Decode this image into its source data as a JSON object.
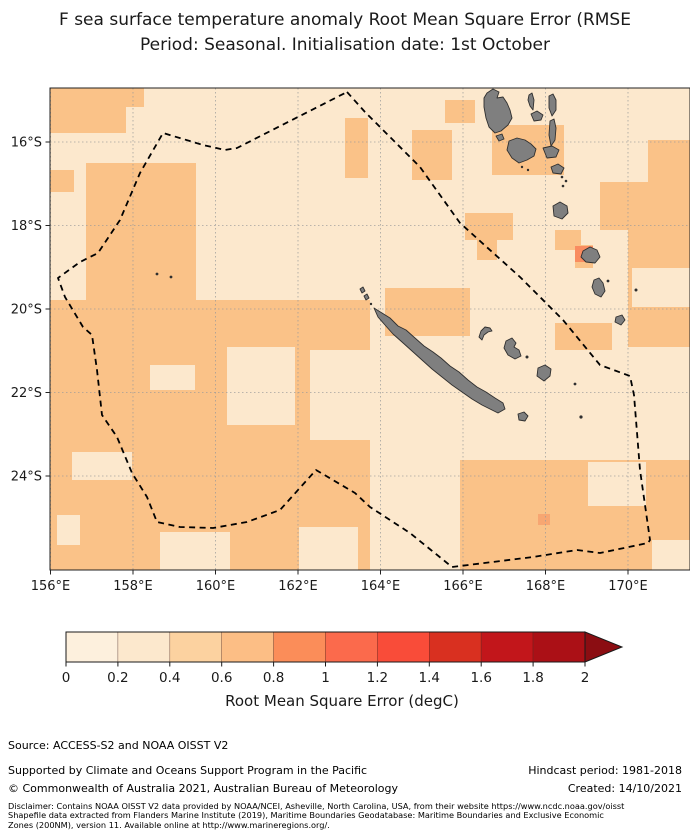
{
  "title": {
    "line1": "F sea surface temperature anomaly Root Mean Square Error (RMSE",
    "line2": "Period: Seasonal. Initialisation date: 1st October"
  },
  "map": {
    "frame": {
      "x": 50,
      "y": 88,
      "w": 640,
      "h": 482
    },
    "x_ticks": [
      {
        "label": "156°E",
        "x": 50.5
      },
      {
        "label": "158°E",
        "x": 133
      },
      {
        "label": "160°E",
        "x": 215.5
      },
      {
        "label": "162°E",
        "x": 298
      },
      {
        "label": "164°E",
        "x": 380.5
      },
      {
        "label": "166°E",
        "x": 463
      },
      {
        "label": "168°E",
        "x": 545.5
      },
      {
        "label": "170°E",
        "x": 628
      }
    ],
    "y_ticks": [
      {
        "label": "16°S",
        "y": 142
      },
      {
        "label": "18°S",
        "y": 225.5
      },
      {
        "label": "20°S",
        "y": 309
      },
      {
        "label": "22°S",
        "y": 392.5
      },
      {
        "label": "24°S",
        "y": 476
      }
    ],
    "colors": {
      "sea_light": "#fce8cd",
      "sea_medium": "#fac288",
      "land": "#7f7f7f",
      "land_outline": "#2f2f2f",
      "grid": "#9a9a9a",
      "frame": "#222222",
      "eez": "#000000"
    },
    "rmse_patches_medium": [
      [
        50,
        88,
        76,
        45
      ],
      [
        126,
        88,
        18,
        19
      ],
      [
        50,
        170,
        24,
        22
      ],
      [
        86,
        163,
        110,
        147
      ],
      [
        50,
        300,
        320,
        270
      ],
      [
        445,
        100,
        30,
        23
      ],
      [
        492,
        125,
        72,
        50
      ],
      [
        412,
        130,
        40,
        50
      ],
      [
        345,
        118,
        23,
        60
      ],
      [
        465,
        213,
        48,
        27
      ],
      [
        477,
        240,
        20,
        20
      ],
      [
        628,
        230,
        62,
        117
      ],
      [
        555,
        230,
        26,
        20
      ],
      [
        555,
        323,
        57,
        27
      ],
      [
        460,
        460,
        230,
        110
      ],
      [
        648,
        140,
        42,
        92
      ],
      [
        600,
        182,
        48,
        48
      ],
      [
        575,
        245,
        18,
        23
      ],
      [
        385,
        288,
        85,
        48
      ]
    ],
    "rmse_patches_light": [
      [
        227,
        347,
        68,
        78
      ],
      [
        150,
        365,
        45,
        25
      ],
      [
        72,
        452,
        60,
        28
      ],
      [
        160,
        532,
        70,
        38
      ],
      [
        299,
        527,
        59,
        43
      ],
      [
        57,
        515,
        23,
        30
      ],
      [
        310,
        350,
        60,
        90
      ],
      [
        588,
        462,
        58,
        44
      ],
      [
        652,
        540,
        38,
        30
      ],
      [
        632,
        268,
        58,
        39
      ]
    ],
    "rmse_cells_high": [
      {
        "x": 575,
        "y": 246,
        "w": 18,
        "h": 16,
        "color": "#f98c60"
      },
      {
        "x": 538,
        "y": 514,
        "w": 12,
        "h": 11,
        "color": "#f7a672"
      }
    ],
    "islands": [
      [
        [
          374,
          308
        ],
        [
          382,
          313
        ],
        [
          390,
          318
        ],
        [
          398,
          326
        ],
        [
          406,
          330
        ],
        [
          415,
          338
        ],
        [
          424,
          346
        ],
        [
          433,
          352
        ],
        [
          441,
          358
        ],
        [
          450,
          366
        ],
        [
          459,
          372
        ],
        [
          468,
          380
        ],
        [
          477,
          387
        ],
        [
          486,
          392
        ],
        [
          495,
          398
        ],
        [
          503,
          403
        ],
        [
          505,
          409
        ],
        [
          498,
          413
        ],
        [
          490,
          409
        ],
        [
          482,
          405
        ],
        [
          472,
          399
        ],
        [
          462,
          392
        ],
        [
          452,
          385
        ],
        [
          442,
          377
        ],
        [
          432,
          369
        ],
        [
          422,
          360
        ],
        [
          412,
          351
        ],
        [
          402,
          342
        ],
        [
          393,
          334
        ],
        [
          385,
          325
        ],
        [
          378,
          317
        ]
      ],
      [
        [
          487,
          93
        ],
        [
          493,
          89
        ],
        [
          499,
          92
        ],
        [
          497,
          98
        ],
        [
          503,
          97
        ],
        [
          507,
          103
        ],
        [
          510,
          110
        ],
        [
          512,
          118
        ],
        [
          508,
          125
        ],
        [
          501,
          131
        ],
        [
          495,
          133
        ],
        [
          489,
          127
        ],
        [
          486,
          118
        ],
        [
          484,
          107
        ],
        [
          484,
          98
        ]
      ],
      [
        [
          496,
          136
        ],
        [
          502,
          134
        ],
        [
          504,
          139
        ],
        [
          499,
          141
        ]
      ],
      [
        [
          529,
          95
        ],
        [
          532,
          93
        ],
        [
          534,
          100
        ],
        [
          533,
          110
        ],
        [
          530,
          106
        ],
        [
          528,
          100
        ]
      ],
      [
        [
          531,
          114
        ],
        [
          537,
          111
        ],
        [
          543,
          115
        ],
        [
          541,
          120
        ],
        [
          534,
          121
        ]
      ],
      [
        [
          549,
          96
        ],
        [
          553,
          94
        ],
        [
          556,
          100
        ],
        [
          556,
          110
        ],
        [
          552,
          116
        ],
        [
          549,
          108
        ]
      ],
      [
        [
          550,
          121
        ],
        [
          554,
          119
        ],
        [
          556,
          128
        ],
        [
          555,
          140
        ],
        [
          551,
          146
        ],
        [
          549,
          135
        ]
      ],
      [
        [
          509,
          141
        ],
        [
          517,
          138
        ],
        [
          525,
          140
        ],
        [
          531,
          144
        ],
        [
          536,
          149
        ],
        [
          534,
          156
        ],
        [
          527,
          160
        ],
        [
          519,
          163
        ],
        [
          512,
          158
        ],
        [
          507,
          150
        ]
      ],
      [
        [
          543,
          148
        ],
        [
          552,
          146
        ],
        [
          559,
          150
        ],
        [
          556,
          157
        ],
        [
          547,
          158
        ]
      ],
      [
        [
          551,
          167
        ],
        [
          558,
          164
        ],
        [
          564,
          168
        ],
        [
          561,
          174
        ],
        [
          553,
          173
        ]
      ],
      [
        [
          553,
          206
        ],
        [
          560,
          202
        ],
        [
          567,
          206
        ],
        [
          568,
          213
        ],
        [
          562,
          219
        ],
        [
          554,
          216
        ]
      ],
      [
        [
          583,
          251
        ],
        [
          590,
          247
        ],
        [
          597,
          250
        ],
        [
          600,
          257
        ],
        [
          595,
          263
        ],
        [
          586,
          262
        ],
        [
          581,
          257
        ]
      ],
      [
        [
          594,
          280
        ],
        [
          599,
          278
        ],
        [
          603,
          283
        ],
        [
          605,
          291
        ],
        [
          601,
          297
        ],
        [
          595,
          294
        ],
        [
          592,
          287
        ]
      ],
      [
        [
          616,
          317
        ],
        [
          622,
          315
        ],
        [
          625,
          320
        ],
        [
          621,
          325
        ],
        [
          615,
          322
        ]
      ],
      [
        [
          479,
          337
        ],
        [
          481,
          331
        ],
        [
          485,
          327
        ],
        [
          490,
          328
        ],
        [
          492,
          331
        ],
        [
          488,
          332
        ],
        [
          484,
          335
        ],
        [
          482,
          340
        ]
      ],
      [
        [
          506,
          341
        ],
        [
          512,
          338
        ],
        [
          516,
          343
        ],
        [
          514,
          347
        ],
        [
          519,
          350
        ],
        [
          521,
          356
        ],
        [
          515,
          359
        ],
        [
          508,
          355
        ],
        [
          504,
          348
        ]
      ],
      [
        [
          538,
          368
        ],
        [
          545,
          365
        ],
        [
          551,
          369
        ],
        [
          550,
          376
        ],
        [
          544,
          381
        ],
        [
          537,
          376
        ]
      ],
      [
        [
          518,
          414
        ],
        [
          524,
          412
        ],
        [
          528,
          416
        ],
        [
          525,
          421
        ],
        [
          519,
          420
        ]
      ],
      [
        [
          360,
          289
        ],
        [
          363,
          287
        ],
        [
          365,
          291
        ],
        [
          362,
          293
        ]
      ],
      [
        [
          364,
          296
        ],
        [
          367,
          294
        ],
        [
          369,
          298
        ],
        [
          366,
          300
        ]
      ]
    ],
    "island_dots": [
      [
        527,
        357,
        1.5
      ],
      [
        562,
        177,
        1.3
      ],
      [
        566,
        181,
        1.3
      ],
      [
        563,
        186,
        1.3
      ],
      [
        608,
        281,
        1.4
      ],
      [
        636,
        290,
        1.5
      ],
      [
        581,
        417,
        1.6
      ],
      [
        575,
        384,
        1.4
      ],
      [
        157,
        274,
        1.4
      ],
      [
        171,
        277,
        1.4
      ],
      [
        371,
        304,
        1.2
      ],
      [
        522,
        167,
        1.2
      ],
      [
        528,
        170,
        1.2
      ]
    ],
    "eez_boundary": [
      [
        347,
        92
      ],
      [
        365,
        112
      ],
      [
        420,
        167
      ],
      [
        460,
        223
      ],
      [
        520,
        277
      ],
      [
        563,
        320
      ],
      [
        600,
        365
      ],
      [
        630,
        376
      ],
      [
        634,
        395
      ],
      [
        640,
        470
      ],
      [
        650,
        540
      ],
      [
        648,
        543
      ],
      [
        600,
        553
      ],
      [
        577,
        550
      ],
      [
        533,
        557
      ],
      [
        452,
        567
      ],
      [
        410,
        533
      ],
      [
        370,
        507
      ],
      [
        355,
        493
      ],
      [
        316,
        470
      ],
      [
        280,
        510
      ],
      [
        247,
        522
      ],
      [
        213,
        528
      ],
      [
        180,
        527
      ],
      [
        157,
        522
      ],
      [
        147,
        497
      ],
      [
        132,
        473
      ],
      [
        117,
        437
      ],
      [
        102,
        415
      ],
      [
        97,
        370
      ],
      [
        92,
        335
      ],
      [
        83,
        327
      ],
      [
        65,
        297
      ],
      [
        58,
        278
      ],
      [
        80,
        262
      ],
      [
        98,
        253
      ],
      [
        120,
        220
      ],
      [
        140,
        173
      ],
      [
        163,
        133
      ],
      [
        203,
        145
      ],
      [
        225,
        150
      ],
      [
        237,
        148
      ],
      [
        347,
        92
      ]
    ]
  },
  "colorbar": {
    "x": 66,
    "y": 632,
    "width": 519,
    "height": 30,
    "segment_colors": [
      "#fdf0dd",
      "#fce8cd",
      "#fcd2a0",
      "#fcbe85",
      "#fb8d59",
      "#fb6a4c",
      "#f94c39",
      "#d93020",
      "#c2161b",
      "#ab1016"
    ],
    "over_color": "#8b0d12",
    "tick_labels": [
      "0",
      "0.2",
      "0.4",
      "0.6",
      "0.8",
      "1",
      "1.2",
      "1.4",
      "1.6",
      "1.8",
      "2"
    ],
    "tick_values": [
      0,
      0.2,
      0.4,
      0.6,
      0.8,
      1,
      1.2,
      1.4,
      1.6,
      1.8,
      2
    ],
    "range": [
      0,
      2
    ],
    "label": "Root Mean Square Error (degC)"
  },
  "footer": {
    "source": "Source: ACCESS-S2 and NOAA OISST V2",
    "supported": "Supported by Climate and Oceans Support Program in the Pacific",
    "copyright": "© Commonwealth of Australia 2021, Australian Bureau of Meteorology",
    "hindcast": "Hindcast period: 1981-2018",
    "created": "Created: 14/10/2021",
    "disclaimer_lines": [
      "Disclaimer: Contains NOAA OISST V2 data provided by NOAA/NCEI, Asheville, North Carolina, USA, from their website https://www.ncdc.noaa.gov/oisst",
      "Shapefile data extracted from Flanders Marine Institute (2019), Maritime Boundaries Geodatabase: Maritime Boundaries and Exclusive Economic",
      "Zones (200NM), version 11. Available online at http://www.marineregions.org/."
    ]
  }
}
